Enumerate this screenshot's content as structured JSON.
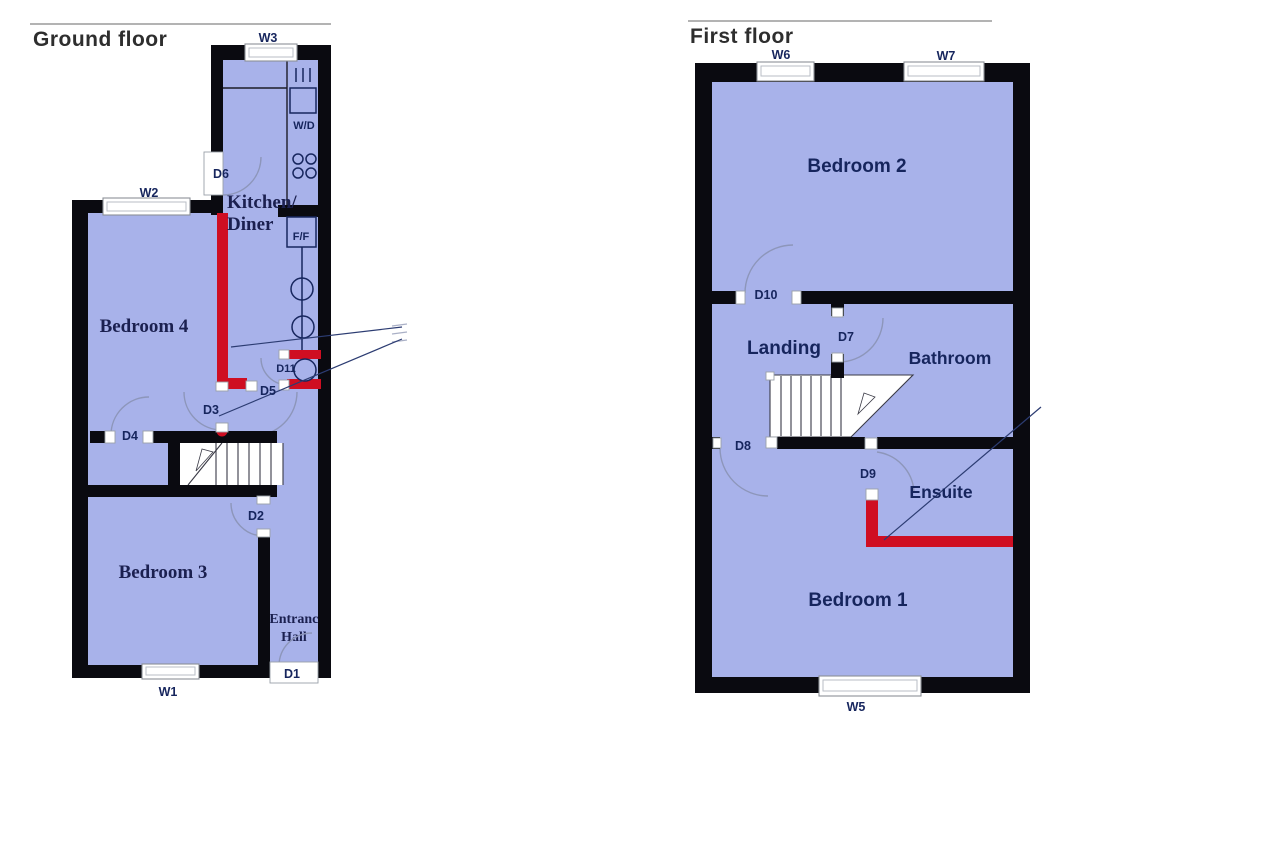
{
  "ground_floor": {
    "title": "Ground floor",
    "rooms": {
      "bedroom4": "Bedroom 4",
      "bedroom3": "Bedroom 3",
      "kitchen_line1": "Kitchen/",
      "kitchen_line2": "Diner",
      "hall_line1": "Entrance",
      "hall_line2": "Hall"
    },
    "windows": {
      "w1": "W1",
      "w2": "W2",
      "w3": "W3"
    },
    "doors": {
      "d1": "D1",
      "d2": "D2",
      "d3": "D3",
      "d4": "D4",
      "d5": "D5",
      "d6": "D6",
      "d11": "D11"
    },
    "appliances": {
      "washer_dryer": "W/D",
      "fridge_freezer": "F/F"
    }
  },
  "first_floor": {
    "title": "First floor",
    "rooms": {
      "bedroom1": "Bedroom 1",
      "bedroom2": "Bedroom 2",
      "landing": "Landing",
      "bathroom": "Bathroom",
      "ensuite": "Ensuite"
    },
    "windows": {
      "w5": "W5",
      "w6": "W6",
      "w7": "W7"
    },
    "doors": {
      "d7": "D7",
      "d8": "D8",
      "d9": "D9",
      "d10": "D10"
    }
  },
  "colors": {
    "floor": "#a8b2ea",
    "wall": "#0a0a10",
    "new_wall_red": "#cf0e22",
    "label_navy": "#16255d"
  }
}
